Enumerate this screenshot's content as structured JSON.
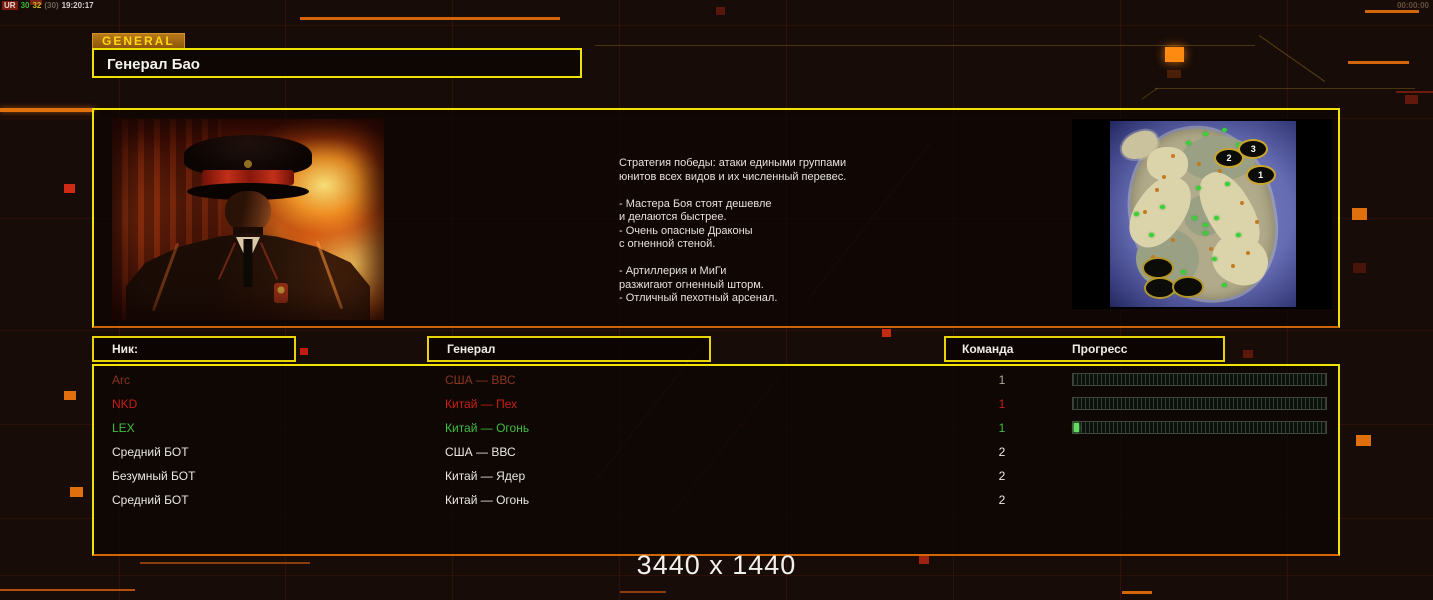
{
  "hud": {
    "debug": {
      "label": "UR",
      "val_a": "30",
      "val_b": "32",
      "val_c": "(30)",
      "time": "19:20:17"
    },
    "clock": "00:00:00"
  },
  "header": {
    "tab_label": "GENERAL",
    "title": "Генерал Бао"
  },
  "briefing": {
    "strategy_text": "Стратегия победы: атаки едиными группами\nюнитов всех видов и их численный перевес.\n\n- Мастера Боя стоят дешевле\nи делаются быстрее.\n- Очень опасные Драконы\nс огненной стеной.\n\n- Артиллерия и МиГи\nразжигают огненный шторм.\n- Отличный пехотный арсенал."
  },
  "minimap": {
    "start_positions": [
      {
        "label": "1"
      },
      {
        "label": "2"
      },
      {
        "label": "3"
      }
    ]
  },
  "lobby_table": {
    "headers": {
      "nick": "Ник:",
      "general": "Генерал",
      "team": "Команда",
      "progress": "Прогресс"
    },
    "rows": [
      {
        "nick": "Arc",
        "general": "США — ВВС",
        "team": "1",
        "color": "#8a3520",
        "team_color": "#b5a795",
        "has_bar": true,
        "progress_pct": 0
      },
      {
        "nick": "NKD",
        "general": "Китай — Пех",
        "team": "1",
        "color": "#c81f14",
        "has_bar": true,
        "progress_pct": 0
      },
      {
        "nick": "LEX",
        "general": "Китай — Огонь",
        "team": "1",
        "color": "#3fbf3f",
        "has_bar": true,
        "progress_pct": 2,
        "bar_fill": "#62dd62"
      },
      {
        "nick": "Средний БОТ",
        "general": "США — ВВС",
        "team": "2",
        "color": "#e9e7e2",
        "has_bar": false,
        "progress_pct": 0
      },
      {
        "nick": "Безумный БОТ",
        "general": "Китай — Ядер",
        "team": "2",
        "color": "#e9e7e2",
        "has_bar": false,
        "progress_pct": 0
      },
      {
        "nick": "Средний БОТ",
        "general": "Китай — Огонь",
        "team": "2",
        "color": "#e9e7e2",
        "has_bar": false,
        "progress_pct": 0
      }
    ]
  },
  "footer": {
    "resolution": "3440 x 1440"
  },
  "colors": {
    "accent_yellow": "#f0e202",
    "accent_orange": "#e0720e",
    "grid_red": "#6e1c0e"
  }
}
